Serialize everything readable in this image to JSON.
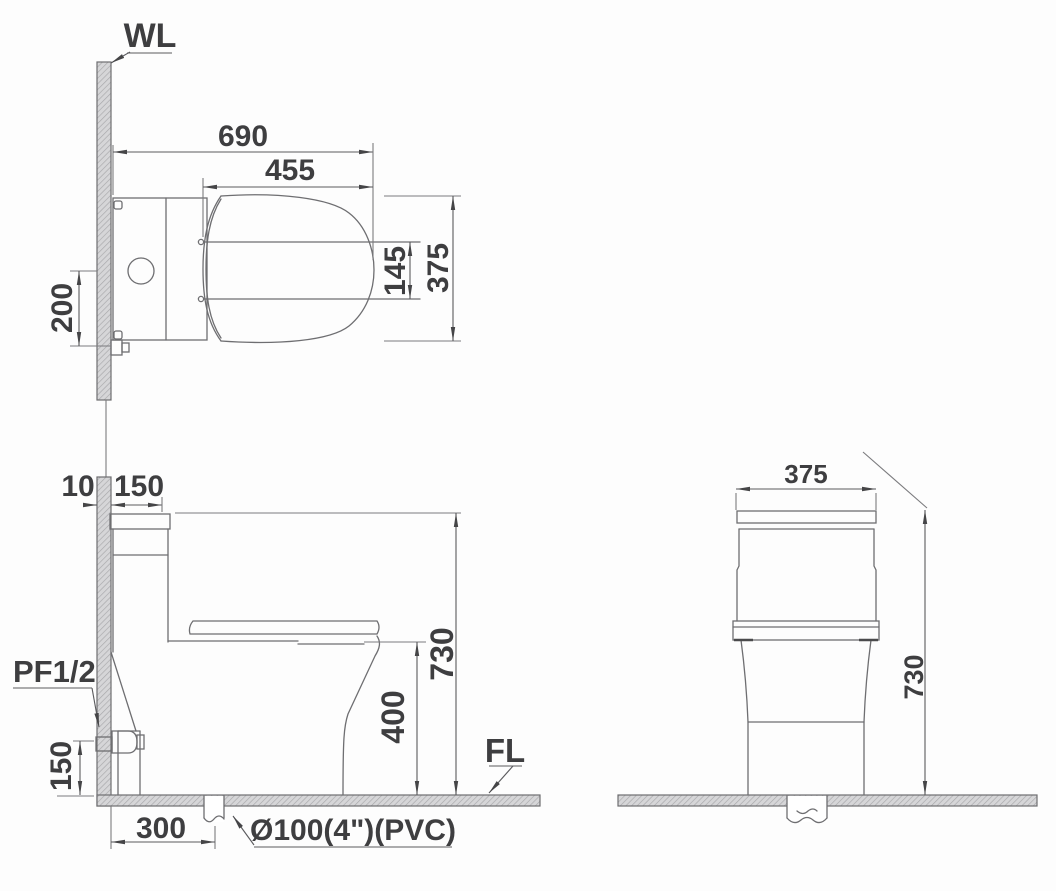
{
  "labels": {
    "water_line": "WL",
    "floor_line": "FL",
    "water_supply": "PF1/2",
    "drain_pipe": "Ø100(4\")(PVC)"
  },
  "plan_view": {
    "overall_depth": "690",
    "seat_depth": "455",
    "overall_width": "375",
    "opening_width": "145",
    "supply_offset": "200"
  },
  "side_view": {
    "wall_gap": "10",
    "tank_top_depth": "150",
    "overall_height": "730",
    "rim_height": "400",
    "supply_height": "150",
    "outlet_from_wall": "300"
  },
  "front_view": {
    "overall_width": "375",
    "overall_height": "730"
  },
  "colors": {
    "line": "#6e6e71",
    "text": "#3e3e40",
    "hatch_fill": "#d6d6d8",
    "hatch_stroke": "#a7a7aa",
    "background": "#ffffff"
  }
}
